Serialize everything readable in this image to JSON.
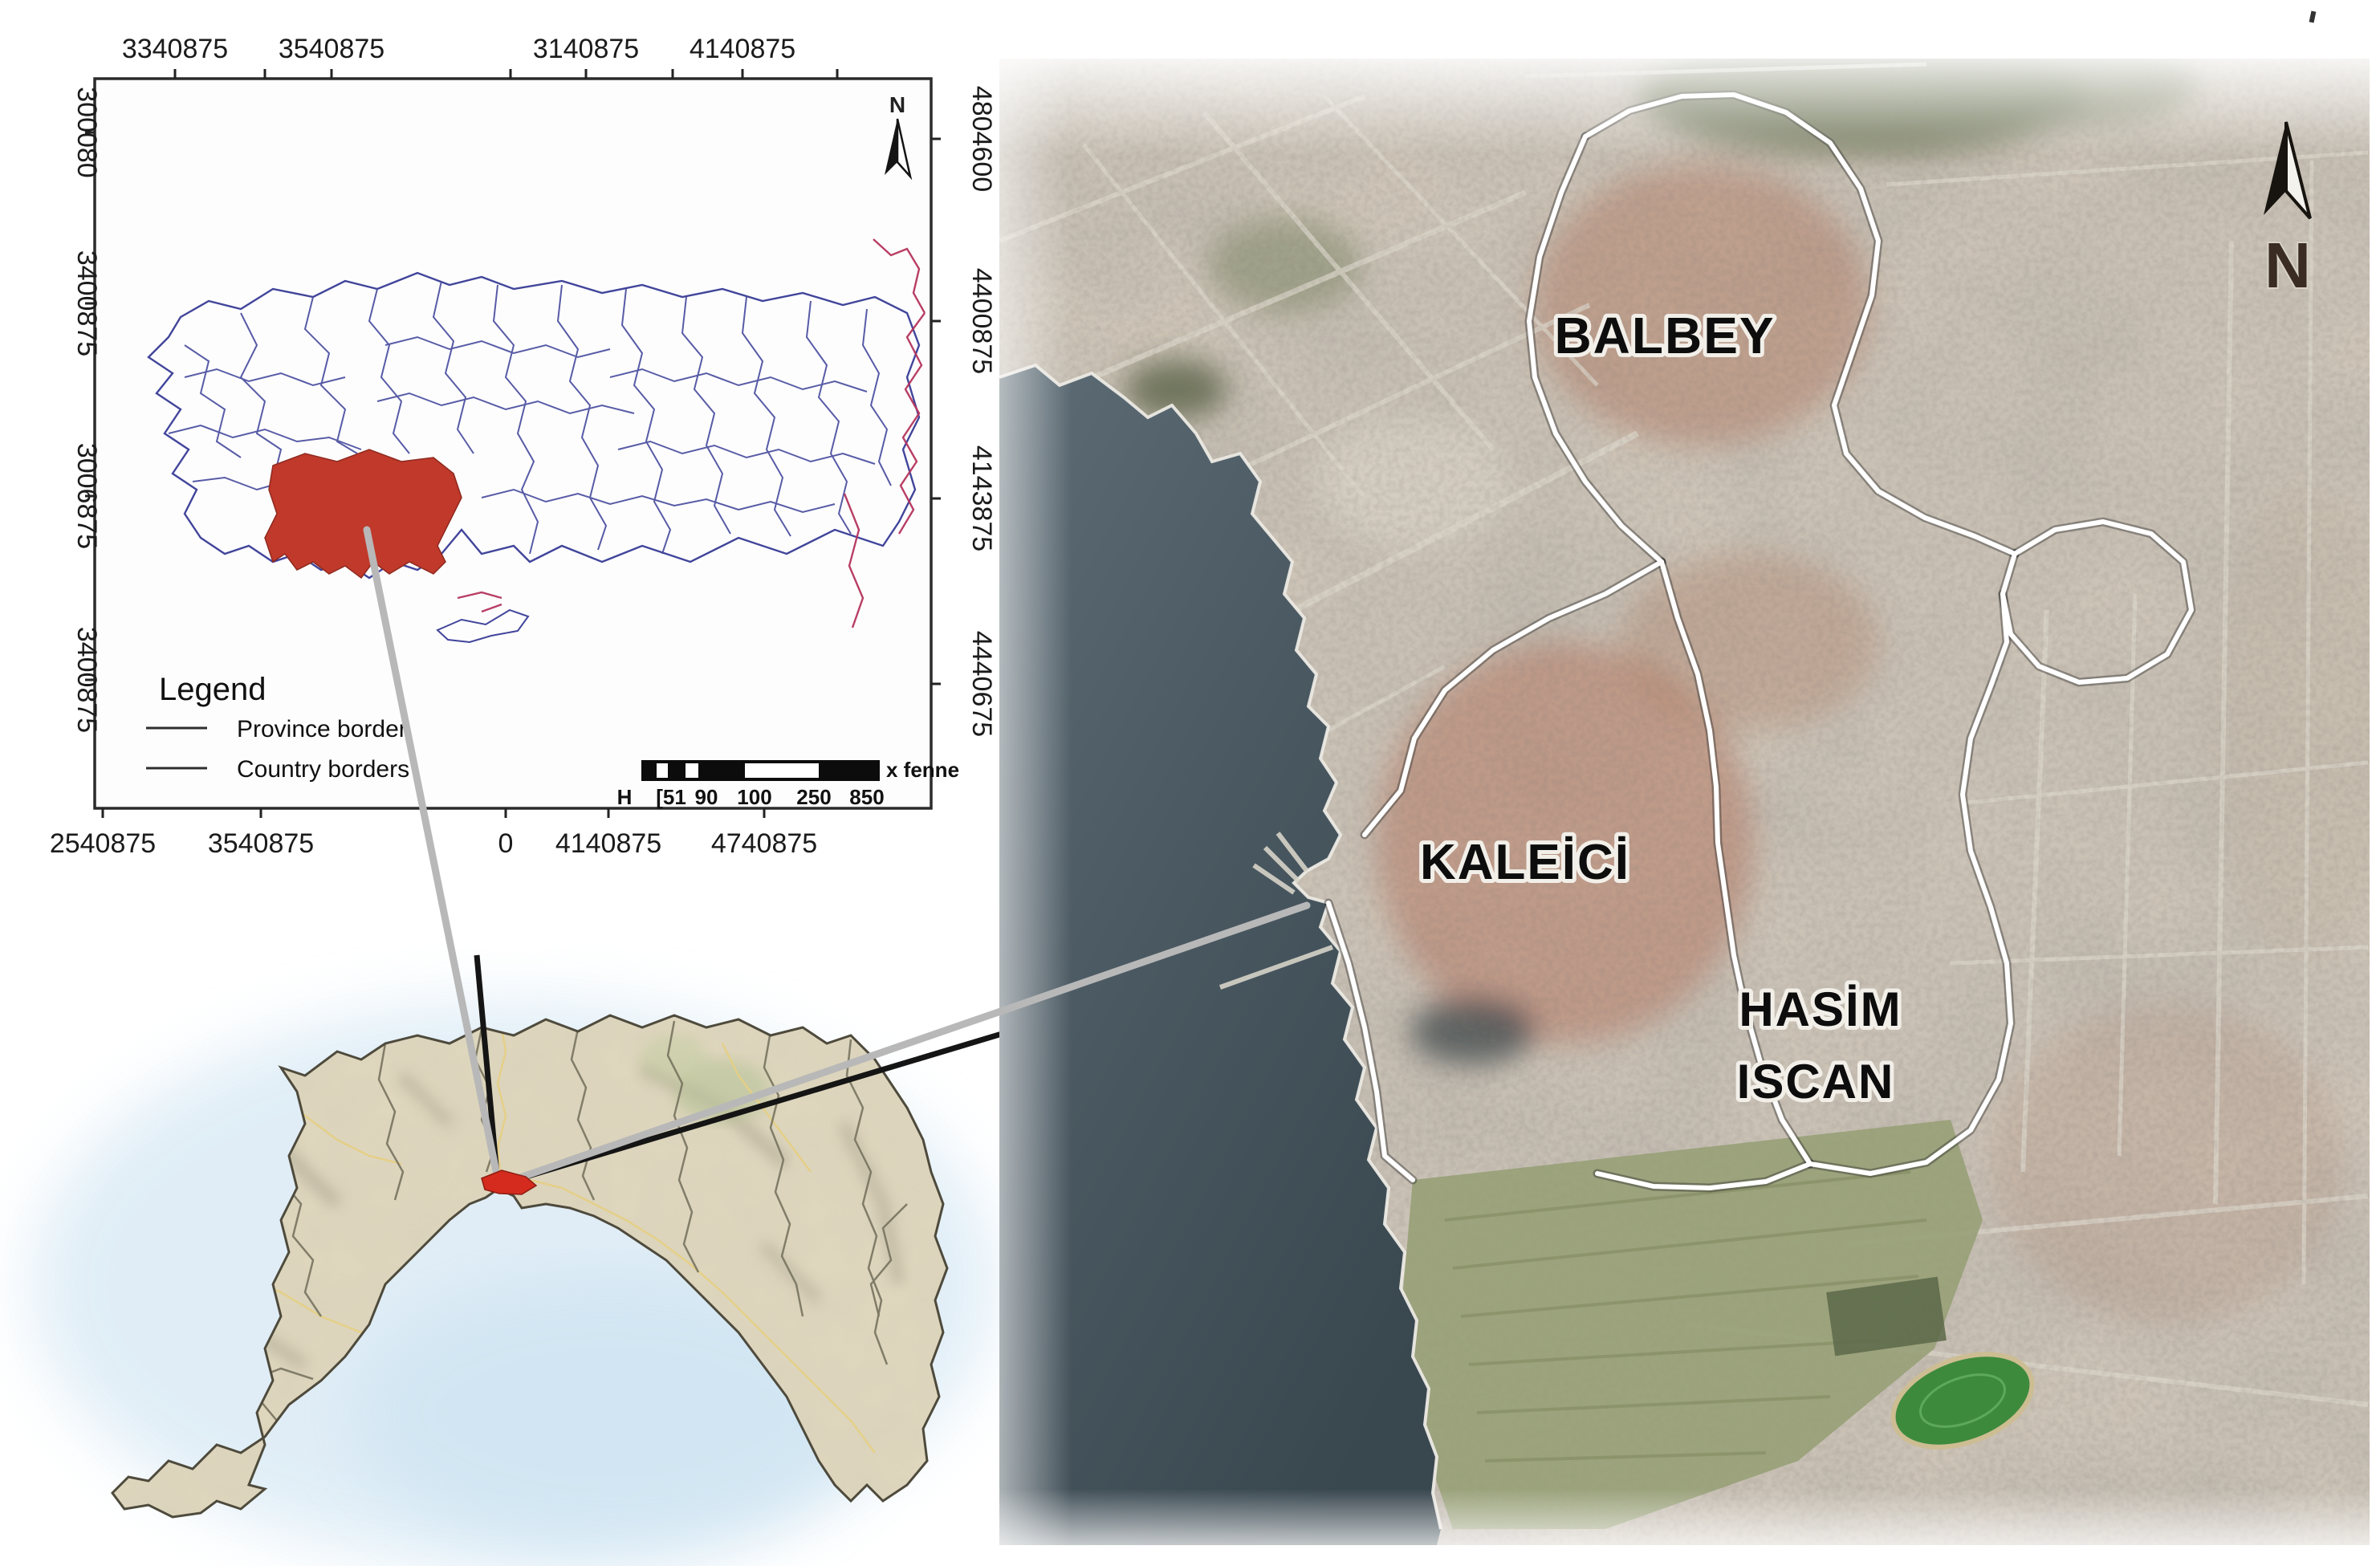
{
  "page": {
    "background": "#ffffff"
  },
  "turkey_inset": {
    "axis_labels": {
      "top": [
        "3340875",
        "3540875",
        "3140875",
        "4140875"
      ],
      "bottom": [
        "2540875",
        "3540875",
        "0",
        "4140875",
        "4740875"
      ],
      "left": [
        "300080",
        "3400875",
        "3006875",
        "3400875"
      ],
      "right": [
        "4804600",
        "4400875",
        "4143875",
        "4440675"
      ]
    },
    "north_arrow_label": "N",
    "legend": {
      "title": "Legend",
      "items": [
        {
          "label": "Province border"
        },
        {
          "label": "Country borders"
        }
      ]
    },
    "scale_bar": {
      "tick_labels": [
        "H",
        "[51",
        "90",
        "100",
        "250",
        "850"
      ],
      "unit_label": "x fenne"
    },
    "colors": {
      "province_border": "#4a4e9e",
      "country_border_east": "#b5345c",
      "highlight_province": "#c0392b"
    }
  },
  "province_inset": {
    "highlight_color": "#d42b1e"
  },
  "satellite_map": {
    "north_arrow_label": "N",
    "district_labels": {
      "balbey": "BALBEY",
      "kaleici": "KALEİCİ",
      "hasim_line1": "HASİM",
      "hasim_line2": "ISCAN"
    }
  },
  "connectors": {
    "leader_color_gray": "#b8b8b8",
    "leader_color_black": "#151515"
  }
}
